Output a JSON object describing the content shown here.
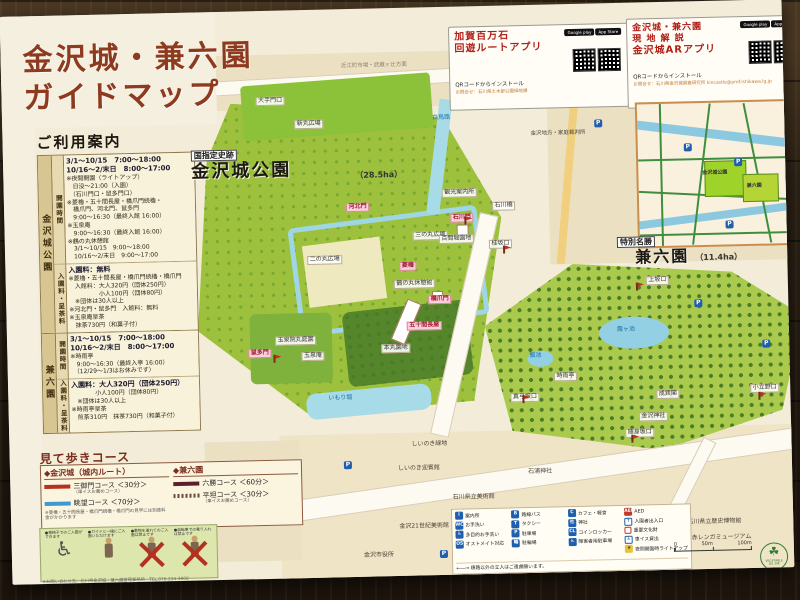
{
  "title": {
    "line1": "金沢城・兼六園",
    "line2": "ガイドマップ"
  },
  "app_boxes": [
    {
      "title_line1": "加賀百万石",
      "title_line2": "回遊ルートアプリ",
      "install": "QRコードからインストール",
      "contact": "お問合せ：石川県土木部公園緑地課",
      "badge_google": "Google play",
      "badge_apple": "App Store"
    },
    {
      "title_line1": "金沢城・兼六園",
      "title_line2": "現 地 解 説",
      "title_line3": "金沢城ARアプリ",
      "install": "QRコードからインストール",
      "contact": "お問合せ：石川県金沢城調査研究所 kincastle@pref.ishikawa.lg.jp",
      "badge_google": "Google play",
      "badge_apple": "App Store"
    }
  ],
  "sidebar": {
    "header": "ご利用案内",
    "sections": [
      {
        "name": "金沢城公園",
        "blocks": [
          {
            "label": "開園時間",
            "lines": [
              "3/1〜10/15　7:00〜18:00",
              "10/16〜2/末日　8:00〜17:00",
              "※夜間開園（ライトアップ）",
              "　日没〜21:00（入園）",
              "　（石川門口・鼠多門口）",
              "※菱櫓・五十間長屋・橋爪門続櫓・",
              "　橋爪門、河北門、鼠多門",
              "　9:00〜16:30（最終入館 16:00）",
              "※玉泉庵",
              "　9:00〜16:30（最終入館 16:00）",
              "※鶴の丸休憩館",
              "　3/1〜10/15　9:00〜18:00",
              "　10/16〜2/末日　9:00〜17:00"
            ]
          },
          {
            "label": "入園料・呈茶料",
            "lines": [
              "入園料：無料",
              "※菱櫓・五十間長屋・橋爪門続櫓・橋爪門",
              "　入館料：大人320円（団体250円）",
              "　　　　　小人100円（団体80円）",
              "　※団体は30人以上",
              "※河北門・鼠多門　入館料：無料",
              "※玉泉庵呈茶",
              "　抹茶730円（和菓子付）"
            ]
          }
        ]
      },
      {
        "name": "兼六園",
        "blocks": [
          {
            "label": "開園時間",
            "lines": [
              "3/1〜10/15　7:00〜18:00",
              "10/16〜2/末日　8:00〜17:00",
              "※時雨亭",
              "　9:00〜16:30（最終入亭 16:00）",
              "　（12/29〜1/3はお休みです）"
            ]
          },
          {
            "label": "入園料・呈茶料",
            "lines": [
              "入園料：大人320円（団体250円）",
              "　　　　小人100円（団体80円）",
              "　※団体は30人以上",
              "※時雨亭呈茶",
              "　煎茶310円　抹茶730円（和菓子付）"
            ]
          }
        ]
      }
    ]
  },
  "courses": {
    "title": "見て歩きコース",
    "castle_heading": "◆金沢城（城内ルート）",
    "castle_items": [
      {
        "name": "三御門コース",
        "time": "＜30分＞",
        "note": "（車イスお薦めコース）",
        "color": "#b5301f"
      },
      {
        "name": "眺望コース",
        "time": "＜70分＞",
        "note": "",
        "color": "#3d9ad1"
      }
    ],
    "castle_footnote": "※菱櫓・五十間長屋・橋爪門続櫓・橋爪門の見学には別途料金がかかります",
    "kenrokuen_heading": "◆兼六園",
    "kenrokuen_items": [
      {
        "name": "六勝コース",
        "time": "＜60分＞",
        "note": "",
        "color": "#5c1f2c"
      },
      {
        "name": "平坦コース",
        "time": "＜30分＞",
        "note": "（車イスお薦めコース）",
        "color": "#6b4a3a"
      }
    ]
  },
  "rules": {
    "captions": [
      "●車椅子でのご入園ができます",
      "●ガイドと一緒にご入園いただけます",
      "●動物を連れてのご入園は禁止です",
      "●自転車での乗り入れは禁止です"
    ],
    "fine_print": [
      "※お問い合わせ先：石川県金沢城・兼六園管理事務所　TEL.076-234-3800",
      "※兼六園観光協会案内所　TEL.076-221-6453",
      "※金沢城公園・兼六園のガイドについては案内所までお尋ねください"
    ]
  },
  "map": {
    "park1_tag": "国指定史跡",
    "park1_name": "金沢城公園",
    "park1_area": "（28.5ha）",
    "park2_tag": "特別名勝",
    "park2_name": "兼六園",
    "park2_area": "（11.4ha）",
    "labels": [
      {
        "text": "新丸広場"
      },
      {
        "text": "大手門口"
      },
      {
        "text": "白鳥路"
      },
      {
        "text": "金沢地方・家庭裁判所"
      },
      {
        "text": "近江町市場・武蔵ヶ辻方面"
      },
      {
        "text": "観光案内所"
      },
      {
        "text": "三の丸広場"
      },
      {
        "text": "二の丸広場"
      },
      {
        "text": "鶴の丸休憩館"
      },
      {
        "text": "石川橋"
      },
      {
        "text": "百間堀園地"
      },
      {
        "text": "桂坂口"
      },
      {
        "text": "菱櫓"
      },
      {
        "text": "五十間長屋"
      },
      {
        "text": "橋爪門"
      },
      {
        "text": "石川門"
      },
      {
        "text": "河北門"
      },
      {
        "text": "鼠多門"
      },
      {
        "text": "玉泉院丸庭園"
      },
      {
        "text": "玉泉庵"
      },
      {
        "text": "いもり堀"
      },
      {
        "text": "本丸園地"
      },
      {
        "text": "霞ヶ池"
      },
      {
        "text": "瓢池"
      },
      {
        "text": "時雨亭"
      },
      {
        "text": "成巽閣"
      },
      {
        "text": "金沢神社"
      },
      {
        "text": "随身坂口"
      },
      {
        "text": "小立野口"
      },
      {
        "text": "上坂口"
      },
      {
        "text": "真弓坂口"
      },
      {
        "text": "しいのき緑地"
      },
      {
        "text": "しいのき迎賓館"
      },
      {
        "text": "石浦神社"
      },
      {
        "text": "石川県立美術館"
      },
      {
        "text": "金沢21世紀美術館"
      },
      {
        "text": "金沢市役所"
      },
      {
        "text": "石川県立歴史博物館"
      },
      {
        "text": "いしかわ赤レンガミュージアム"
      },
      {
        "text": "国立工芸館"
      }
    ]
  },
  "legend": {
    "items": [
      {
        "glyph": "i",
        "label": "案内所"
      },
      {
        "glyph": "WC",
        "label": "お手洗い"
      },
      {
        "glyph": "♿",
        "label": "多目的お手洗い"
      },
      {
        "glyph": "OS",
        "label": "オストメイト対応"
      },
      {
        "glyph": "B",
        "label": "路線バス"
      },
      {
        "glyph": "T",
        "label": "タクシー"
      },
      {
        "glyph": "P",
        "label": "駐車場"
      },
      {
        "glyph": "輪",
        "label": "駐輪場"
      },
      {
        "glyph": "C",
        "label": "カフェ・軽食"
      },
      {
        "glyph": "社",
        "label": "神社"
      },
      {
        "glyph": "CL",
        "label": "コインロッカー"
      },
      {
        "glyph": "♿",
        "label": "障害者用駐車場"
      },
      {
        "glyph": "AED",
        "label": "AED"
      },
      {
        "glyph": "↑",
        "label": "入園者出入口"
      },
      {
        "glyph": "",
        "label": "重要文化財"
      },
      {
        "glyph": "♿",
        "label": "車イス貸出"
      },
      {
        "glyph": "★",
        "label": "夜間開園時ライトアップ"
      }
    ],
    "note": "←―→ 順路以外の立入はご遠慮願います。"
  },
  "inset": {
    "park1": "金沢城公園",
    "park2": "兼六園"
  },
  "scale": {
    "zero": "0",
    "mid": "50m",
    "end": "100m"
  },
  "logo": {
    "line1": "VEGETABLE",
    "line2": "OIL INK"
  },
  "colors": {
    "park_green": "#9dc13d",
    "kenrokuen_green": "#a9ca4d",
    "water_blue": "#9fd6e6",
    "title_brown": "#8e3a1e",
    "course_red": "#b5301f",
    "course_blue": "#3d9ad1",
    "course_maroon": "#5c1f2c"
  }
}
